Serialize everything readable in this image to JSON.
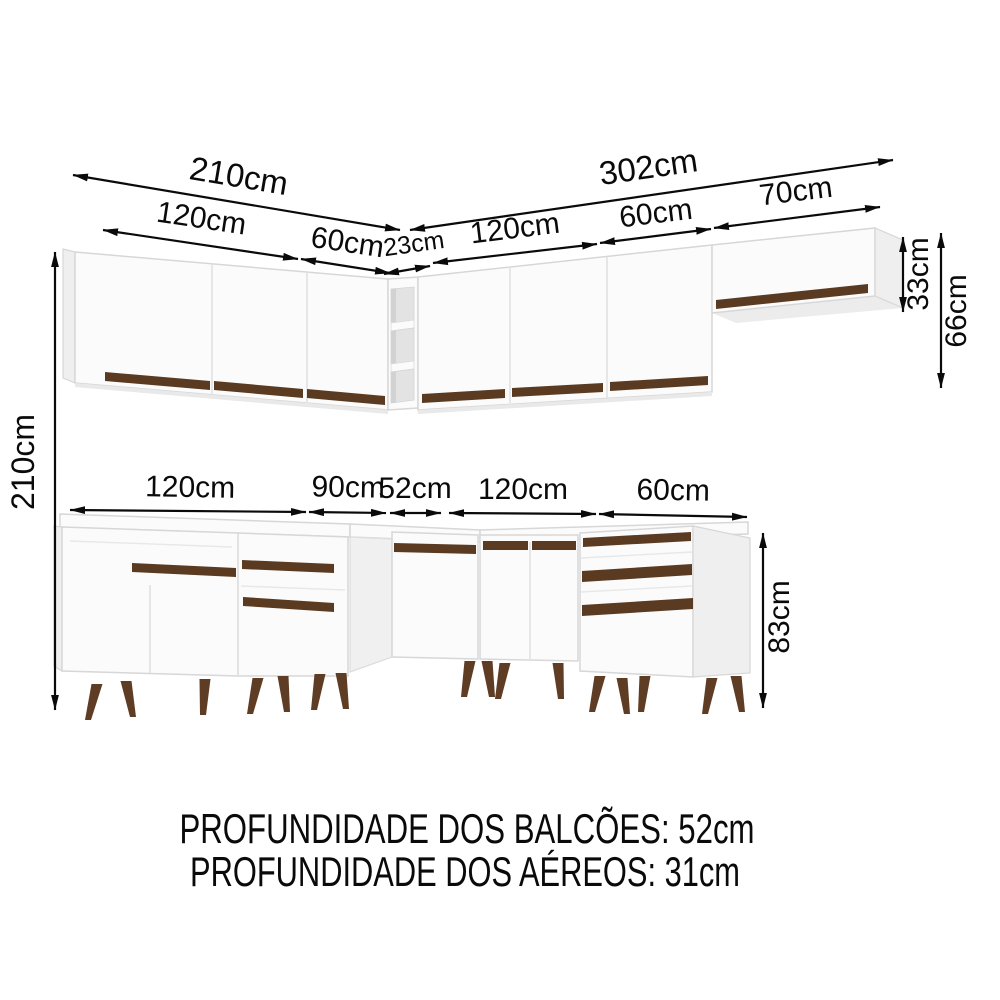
{
  "diagram": {
    "upper": {
      "total_left": "210cm",
      "left_section_1": "120cm",
      "left_section_2": "60cm",
      "corner_shelf": "23cm",
      "total_right": "302cm",
      "right_section_1": "120cm",
      "right_section_2": "60cm",
      "right_section_3": "70cm",
      "end_cabinet_height": "33cm",
      "aereo_height": "66cm"
    },
    "total_height": "210cm",
    "lower": {
      "section_1": "120cm",
      "section_2": "90cm",
      "corner": "52cm",
      "section_3": "120cm",
      "section_4": "60cm",
      "balcao_height": "83cm"
    },
    "notes": {
      "balcoes_depth": "PROFUNDIDADE DOS BALCÕES: 52cm",
      "aereos_depth": "PROFUNDIDADE DOS AÉREOS: 31cm"
    },
    "colors": {
      "handle_brown": "#5a3a21",
      "foot_brown": "#5e3d24",
      "line_black": "#0a0a0a",
      "cabinet_white": "#fbfbfb",
      "side_gray": "#efefef",
      "niche_gray": "#e3e3e3"
    }
  }
}
